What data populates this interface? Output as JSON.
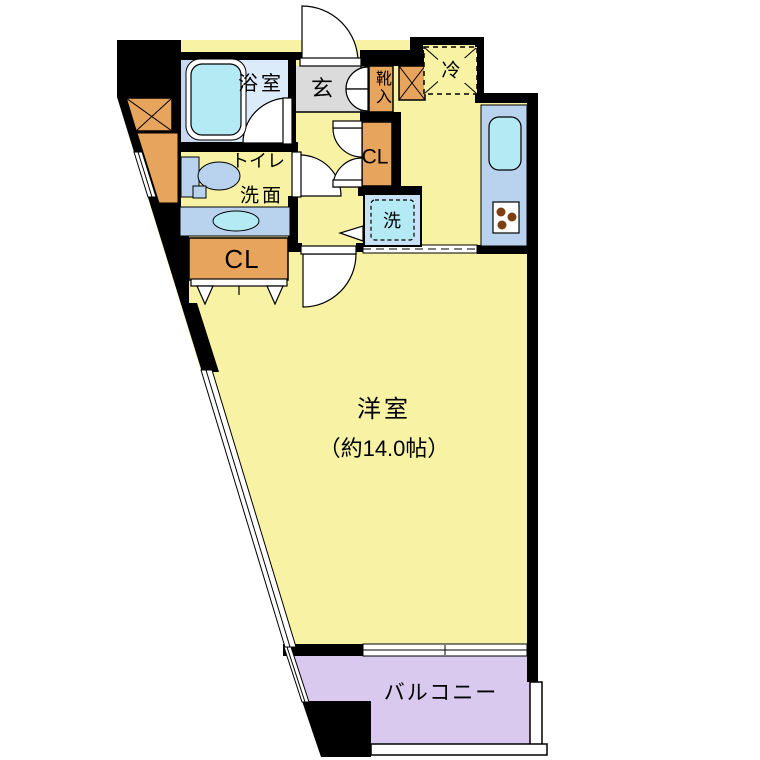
{
  "plan": {
    "type": "apartment-floor-plan",
    "labels": {
      "bathroom": "浴室",
      "entrance": "玄",
      "shoe_cabinet": "靴入",
      "refrigerator": "冷",
      "toilet": "トイレ",
      "vanity": "洗面",
      "closet_hall": "CL",
      "closet_room": "CL",
      "washer": "洗",
      "main_room": "洋室",
      "main_room_size": "（約14.0帖）",
      "balcony": "バルコニー"
    },
    "colors": {
      "floor_yellow": "#f7f2a4",
      "bathroom_blue": "#dcebf9",
      "tub_surround_blue": "#c8d8f0",
      "fixture_cyan": "#b4eaf4",
      "counter_blue": "#b9d3ee",
      "storage_orange": "#e7a45c",
      "entrance_gray": "#dbdbdb",
      "balcony_purple": "#d9c9ee",
      "washer_blue": "#c9e1f5",
      "burner_brown": "#7d3f12",
      "wall_black": "#000000"
    }
  }
}
